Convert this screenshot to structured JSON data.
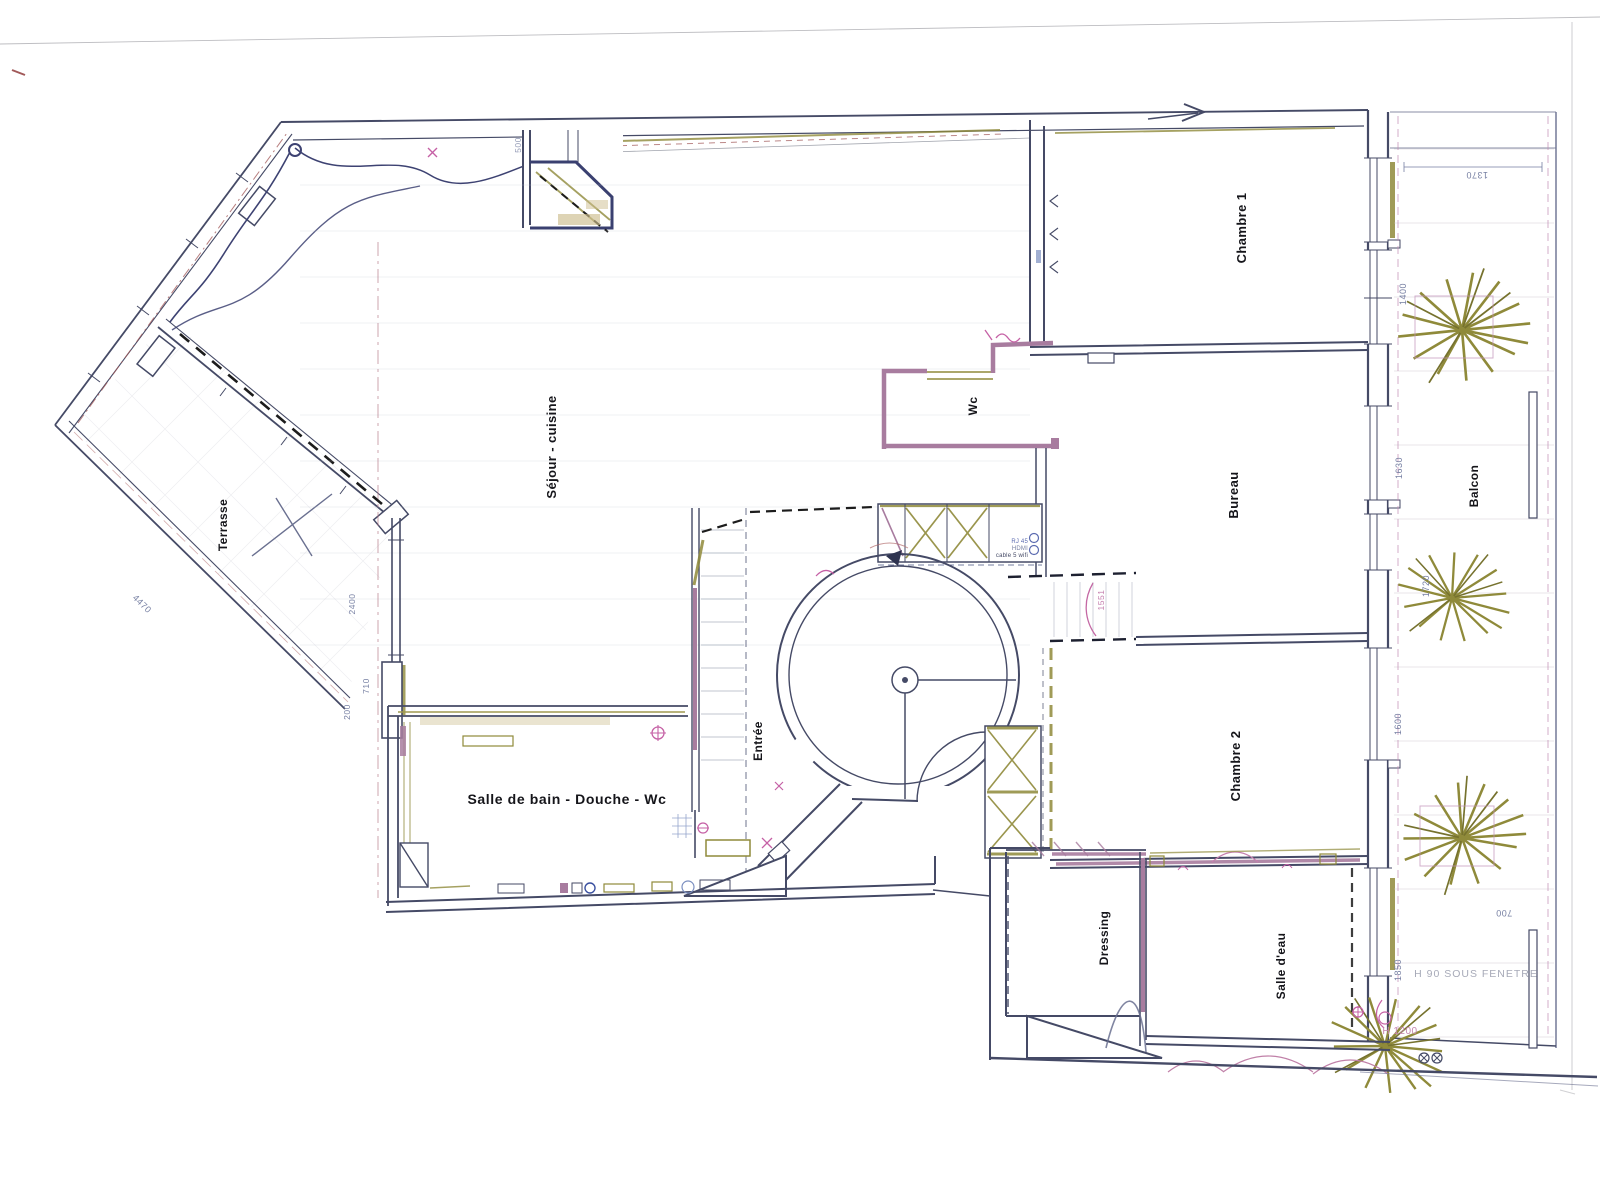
{
  "plan": {
    "rooms": {
      "terrasse": "Terrasse",
      "sejour": "Séjour - cuisine",
      "entree": "Entrée",
      "wc": "Wc",
      "chambre1": "Chambre 1",
      "bureau": "Bureau",
      "chambre2": "Chambre 2",
      "dressing": "Dressing",
      "salle_eau": "Salle d'eau",
      "balcon": "Balcon",
      "salle_de_bain": "Salle de bain - Douche - Wc"
    },
    "dims": {
      "d1370": "1370",
      "d1400": "1400",
      "d1630": "1630",
      "d1720": "1720",
      "d1600": "1600",
      "d1850": "1850",
      "d700": "700",
      "d2400": "2400",
      "d710": "710",
      "d200": "200",
      "d4470": "4470",
      "d500": "500",
      "d1551": "1551"
    },
    "annotations": {
      "h90": "H 90 SOUS FENETRE",
      "h1200": "H 1200",
      "rj45": "RJ 45",
      "hdmi": "HDMI",
      "cable": "cable 5 wifi"
    },
    "colors": {
      "wall": "#454a66",
      "purple": "#a87c9f",
      "khaki": "#8f8a3a",
      "tan": "#cdbd8e",
      "pink": "#c560a5",
      "blue": "#7b8fc0",
      "dim": "#767fa2",
      "scan_edge": "#9a9aa0",
      "dash_red": "#a05555"
    }
  }
}
